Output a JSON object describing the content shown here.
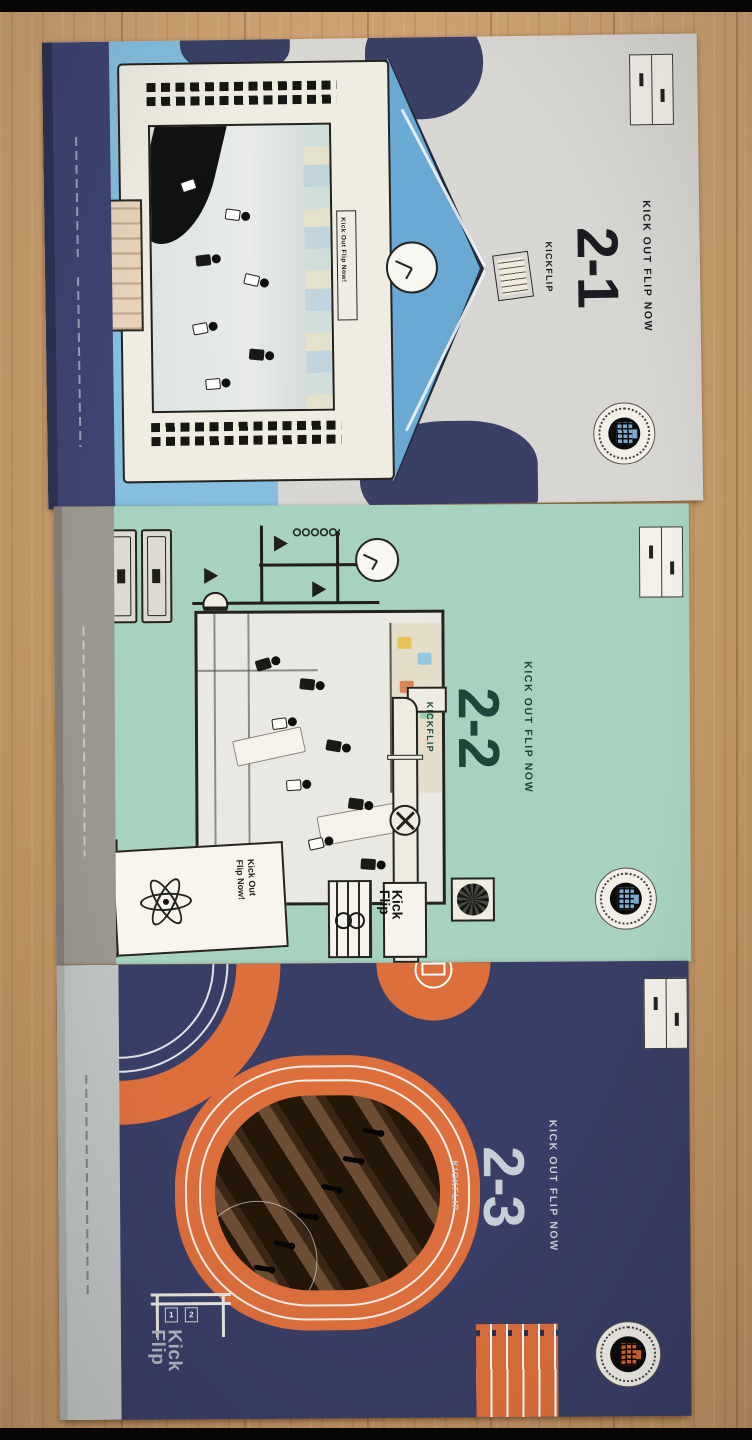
{
  "colors": {
    "wood": "#c59a67",
    "letterbox": "#060606",
    "a1cover": "#d8d6d2",
    "a1spine": "#3d4472",
    "a1blue": "#85bedf",
    "roofblue": "#69a9d4",
    "navy": "#3a3f66",
    "cream": "#efece1",
    "ink": "#1b1b22",
    "a2cover": "#a6d2bf",
    "a2spine": "#9b968e",
    "a2text": "#1d453a",
    "a3cover": "#393e66",
    "a3spine": "#bfc3c1",
    "a3text": "#c9cdd6",
    "orange": "#dd6f3c"
  },
  "albums": [
    {
      "header": "KICK OUT FLIP NOW",
      "number": "2-1",
      "artist": "KICKFLIP",
      "banner_label": "Kick Out Flip Now!"
    },
    {
      "header": "KICK OUT FLIP NOW",
      "number": "2-2",
      "artist": "KICKFLIP",
      "sign_line1": "Kick Out",
      "sign_line2": "Flip Now!",
      "poster_logo_line1": "Kick",
      "poster_logo_line2": "Flip"
    },
    {
      "header": "KICK OUT FLIP NOW",
      "number": "2-3",
      "artist": "KICKFLIP",
      "logo_line1": "Kick",
      "logo_line2": "Flip",
      "lane_numbers": [
        "1",
        "2"
      ]
    }
  ]
}
